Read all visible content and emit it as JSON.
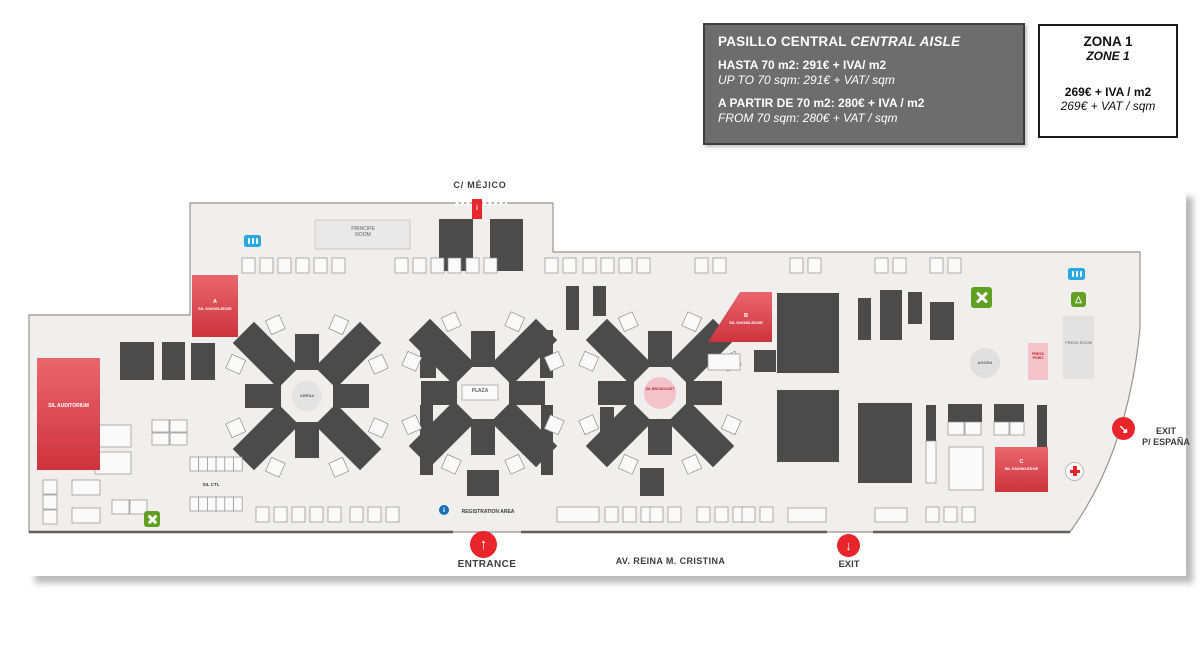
{
  "title_boxes": {
    "central_aisle": {
      "title_es": "PASILLO CENTRAL",
      "title_en": "CENTRAL AISLE",
      "price1_es": "HASTA 70 m2: 291€ + IVA/ m2",
      "price1_en": "UP TO 70 sqm: 291€ + VAT/ sqm",
      "price2_es": "A PARTIR DE 70 m2: 280€ + IVA / m2",
      "price2_en": "FROM 70 sqm: 280€ + VAT / sqm"
    },
    "zone1": {
      "title_es": "ZONA 1",
      "title_en": "ZONE 1",
      "price_es": "269€ + IVA / m2",
      "price_en": "269€ + VAT / sqm"
    }
  },
  "map": {
    "streets": {
      "top": "C/ MÉJICO",
      "bottom": "AV. REINA M. CRISTINA"
    },
    "access": {
      "entrance": "ENTRANCE",
      "exit": "EXIT",
      "exit_espana_l1": "EXIT",
      "exit_espana_l2": "P/ ESPAÑA",
      "registration": "REGISTRATION AREA"
    },
    "areas": {
      "principe_room": "PRINCIPE ROOM",
      "sil_auditorium": "SIL AUDITORIUM",
      "sil_knowledge": "SIL KNOWLEDGE",
      "knowledge_a": "A",
      "knowledge_b": "B",
      "knowledge_c": "C",
      "sil_broadcast": "SIL BROADCAST",
      "sil_ctl": "SIL CTL",
      "arena": "ARENA",
      "plaza": "PLAZA",
      "agora": "AGORA",
      "press_point": "PRESS POINT",
      "press_room": "PRESS ROOM"
    },
    "icons": {
      "entrance_arrow": "↑",
      "exit_arrow": "↓",
      "exit_espana_arrow": "↘",
      "info": "i",
      "recycle_glyph": "△"
    },
    "colors": {
      "red_zone": "#d8434c",
      "accent_red": "#e8252b",
      "pink": "#f4c3ca",
      "dark_booth": "#4b4b4b",
      "floor": "#f0efee",
      "wc_blue": "#2aa8df",
      "green": "#61a023"
    }
  }
}
